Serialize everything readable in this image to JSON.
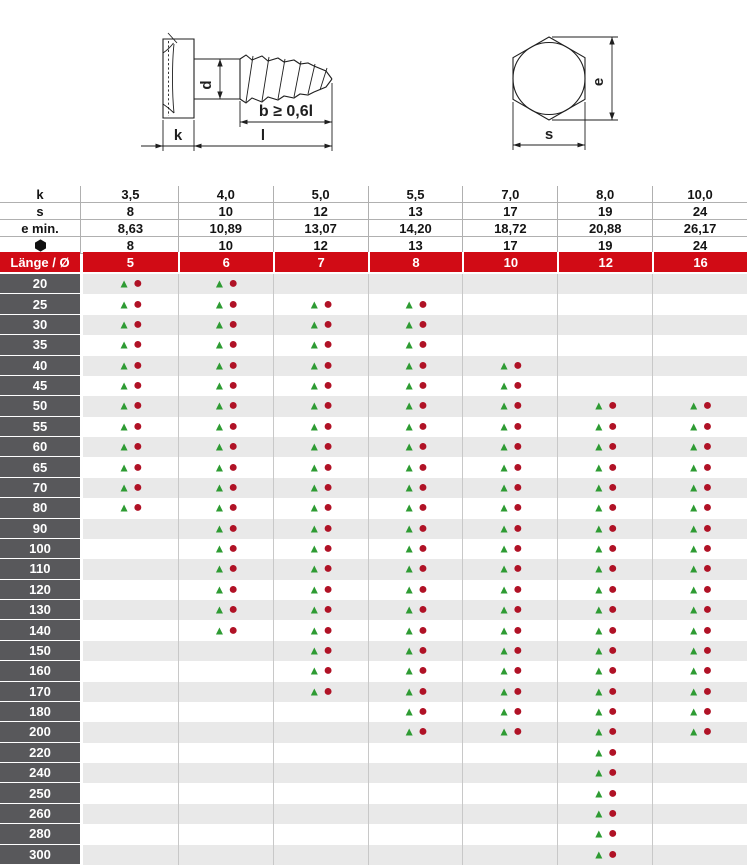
{
  "diagram": {
    "screw_labels": {
      "d": "d",
      "b": "b ≥  0,6l",
      "k": "k",
      "l": "l"
    },
    "head_labels": {
      "e": "e",
      "s": "s"
    }
  },
  "spec_table": {
    "rows": [
      {
        "label": "k",
        "icon": null,
        "values": [
          "3,5",
          "4,0",
          "5,0",
          "5,5",
          "7,0",
          "8,0",
          "10,0"
        ]
      },
      {
        "label": "s",
        "icon": null,
        "values": [
          "8",
          "10",
          "12",
          "13",
          "17",
          "19",
          "24"
        ]
      },
      {
        "label": "e min.",
        "icon": null,
        "values": [
          "8,63",
          "10,89",
          "13,07",
          "14,20",
          "18,72",
          "20,88",
          "26,17"
        ]
      },
      {
        "label": "",
        "icon": "hexagon-icon",
        "values": [
          "8",
          "10",
          "12",
          "13",
          "17",
          "19",
          "24"
        ]
      }
    ]
  },
  "size_table": {
    "corner_label": "Länge / Ø",
    "diameters": [
      "5",
      "6",
      "7",
      "8",
      "10",
      "12",
      "16"
    ],
    "marker": {
      "triangle_glyph": "▲",
      "circle_glyph": "●",
      "triangle_color": "#2e9b33",
      "circle_color": "#b01226"
    },
    "rows": [
      {
        "length": "20",
        "marks": [
          1,
          1,
          0,
          0,
          0,
          0,
          0
        ]
      },
      {
        "length": "25",
        "marks": [
          1,
          1,
          1,
          1,
          0,
          0,
          0
        ]
      },
      {
        "length": "30",
        "marks": [
          1,
          1,
          1,
          1,
          0,
          0,
          0
        ]
      },
      {
        "length": "35",
        "marks": [
          1,
          1,
          1,
          1,
          0,
          0,
          0
        ]
      },
      {
        "length": "40",
        "marks": [
          1,
          1,
          1,
          1,
          1,
          0,
          0
        ]
      },
      {
        "length": "45",
        "marks": [
          1,
          1,
          1,
          1,
          1,
          0,
          0
        ]
      },
      {
        "length": "50",
        "marks": [
          1,
          1,
          1,
          1,
          1,
          1,
          1
        ]
      },
      {
        "length": "55",
        "marks": [
          1,
          1,
          1,
          1,
          1,
          1,
          1
        ]
      },
      {
        "length": "60",
        "marks": [
          1,
          1,
          1,
          1,
          1,
          1,
          1
        ]
      },
      {
        "length": "65",
        "marks": [
          1,
          1,
          1,
          1,
          1,
          1,
          1
        ]
      },
      {
        "length": "70",
        "marks": [
          1,
          1,
          1,
          1,
          1,
          1,
          1
        ]
      },
      {
        "length": "80",
        "marks": [
          1,
          1,
          1,
          1,
          1,
          1,
          1
        ]
      },
      {
        "length": "90",
        "marks": [
          0,
          1,
          1,
          1,
          1,
          1,
          1
        ]
      },
      {
        "length": "100",
        "marks": [
          0,
          1,
          1,
          1,
          1,
          1,
          1
        ]
      },
      {
        "length": "110",
        "marks": [
          0,
          1,
          1,
          1,
          1,
          1,
          1
        ]
      },
      {
        "length": "120",
        "marks": [
          0,
          1,
          1,
          1,
          1,
          1,
          1
        ]
      },
      {
        "length": "130",
        "marks": [
          0,
          1,
          1,
          1,
          1,
          1,
          1
        ]
      },
      {
        "length": "140",
        "marks": [
          0,
          1,
          1,
          1,
          1,
          1,
          1
        ]
      },
      {
        "length": "150",
        "marks": [
          0,
          0,
          1,
          1,
          1,
          1,
          1
        ]
      },
      {
        "length": "160",
        "marks": [
          0,
          0,
          1,
          1,
          1,
          1,
          1
        ]
      },
      {
        "length": "170",
        "marks": [
          0,
          0,
          1,
          1,
          1,
          1,
          1
        ]
      },
      {
        "length": "180",
        "marks": [
          0,
          0,
          0,
          1,
          1,
          1,
          1
        ]
      },
      {
        "length": "200",
        "marks": [
          0,
          0,
          0,
          1,
          1,
          1,
          1
        ]
      },
      {
        "length": "220",
        "marks": [
          0,
          0,
          0,
          0,
          0,
          1,
          0
        ]
      },
      {
        "length": "240",
        "marks": [
          0,
          0,
          0,
          0,
          0,
          1,
          0
        ]
      },
      {
        "length": "250",
        "marks": [
          0,
          0,
          0,
          0,
          0,
          1,
          0
        ]
      },
      {
        "length": "260",
        "marks": [
          0,
          0,
          0,
          0,
          0,
          1,
          0
        ]
      },
      {
        "length": "280",
        "marks": [
          0,
          0,
          0,
          0,
          0,
          1,
          0
        ]
      },
      {
        "length": "300",
        "marks": [
          0,
          0,
          0,
          0,
          0,
          1,
          0
        ]
      }
    ]
  },
  "colors": {
    "header_red": "#d10b15",
    "row_label_gray": "#58585b",
    "row_alt_gray": "#e9e9e9",
    "grid_line": "#c8c8c8",
    "spec_line": "#b0b0b0",
    "marker_green": "#2e9b33",
    "marker_red": "#b01226"
  }
}
